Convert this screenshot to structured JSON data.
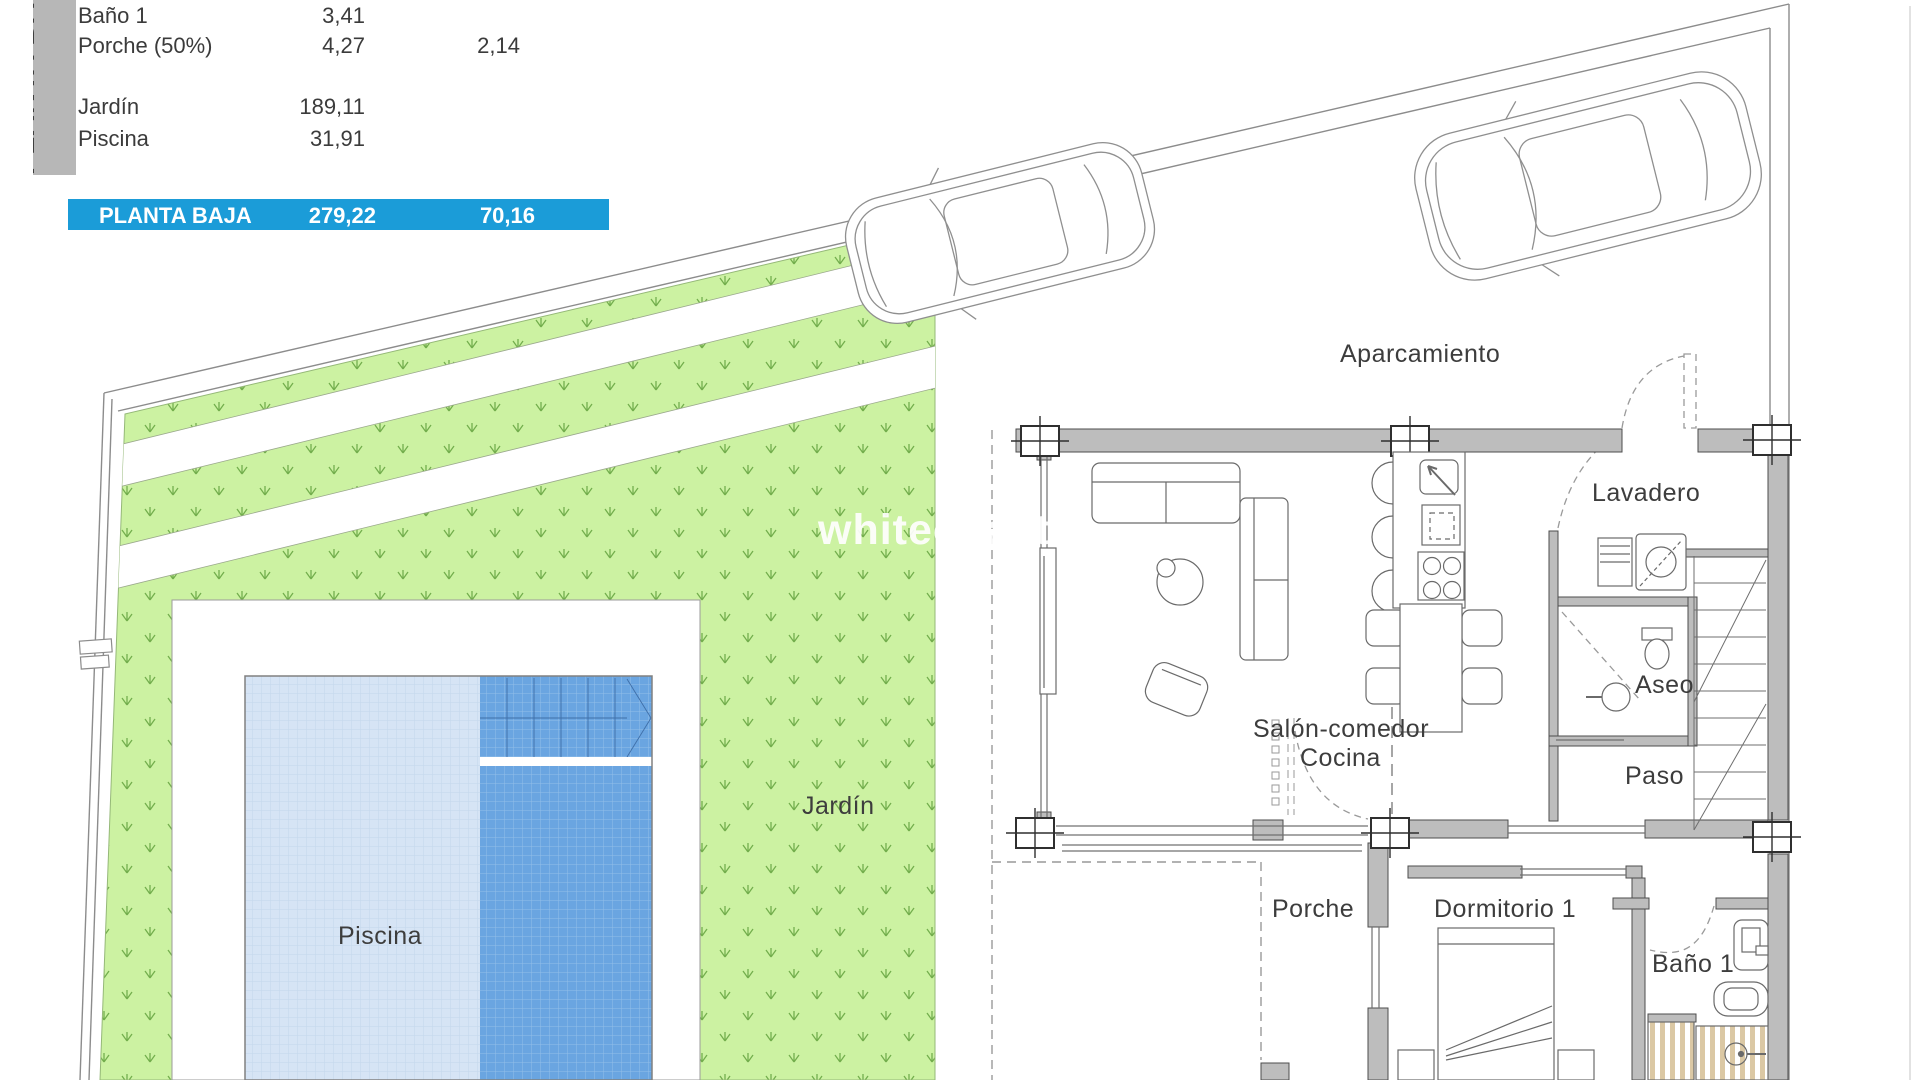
{
  "legend_panel": {
    "tab_vertical_label": "PLANTA BAJA",
    "rows": [
      {
        "name": "Baño 1",
        "value1": "3,41",
        "value2": ""
      },
      {
        "name": "Porche (50%)",
        "value1": "4,27",
        "value2": "2,14"
      },
      {
        "name": "Jardín",
        "value1": "189,11",
        "value2": ""
      },
      {
        "name": "Piscina",
        "value1": "31,91",
        "value2": ""
      }
    ],
    "total_row": {
      "name": "PLANTA BAJA",
      "value1": "279,22",
      "value2": "70,16"
    }
  },
  "floorplan": {
    "watermark": "whitecoast",
    "rooms": {
      "aparcamiento": {
        "label": "Aparcamiento"
      },
      "lavadero": {
        "label": "Lavadero"
      },
      "aseo": {
        "label": "Aseo"
      },
      "paso": {
        "label": "Paso"
      },
      "salon": {
        "label": "Salón-comedor"
      },
      "cocina": {
        "label": "Cocina"
      },
      "porche": {
        "label": "Porche"
      },
      "dormitorio1": {
        "label": "Dormitorio 1"
      },
      "bano1": {
        "label": "Baño 1"
      },
      "jardin": {
        "label": "Jardín"
      },
      "piscina": {
        "label": "Piscina"
      }
    },
    "colors": {
      "grass": "#ccf2a2",
      "grass_mark": "#64a23e",
      "pool_light": "#d6e4f5",
      "pool_dark": "#6aa5e1",
      "wall_gray": "#bdbdbd",
      "highlight_blue": "#1b9cd8",
      "tab_gray": "#b7b7b7",
      "shower_stripe": "#dbc8a4"
    }
  }
}
